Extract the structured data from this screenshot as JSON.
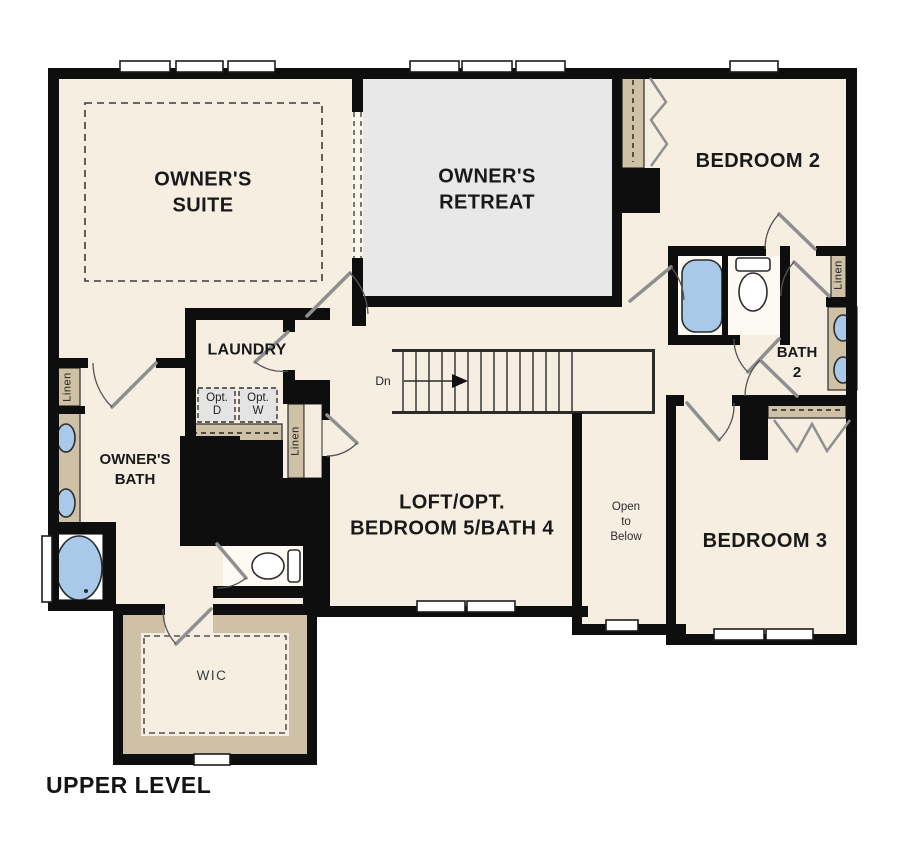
{
  "title": "UPPER LEVEL",
  "rooms": {
    "owner_suite": {
      "label": "OWNER'S\nSUITE"
    },
    "owner_retreat": {
      "label": "OWNER'S\nRETREAT"
    },
    "bedroom2": {
      "label": "BEDROOM 2"
    },
    "bedroom3": {
      "label": "BEDROOM 3"
    },
    "loft": {
      "label": "LOFT/OPT.\nBEDROOM 5/BATH 4"
    },
    "laundry": {
      "label": "LAUNDRY"
    },
    "owners_bath": {
      "label": "OWNER'S\nBATH"
    },
    "bath2": {
      "label": "BATH\n2"
    },
    "wic": {
      "label": "WIC"
    },
    "open_to_below": {
      "label": "Open\nto\nBelow"
    }
  },
  "annotations": {
    "stairs_direction": "Dn",
    "linen": "Linen",
    "optional_dryer": "Opt.\nD",
    "optional_washer": "Opt.\nW"
  },
  "colors": {
    "wall": "#0e0e0e",
    "room_cream": "#f6eee1",
    "room_gray": "#e8e8e8",
    "cabinet_tan": "#cfc1a5",
    "fixture_blue": "#a9c9e9",
    "appliance_gray": "#e4e4e4"
  }
}
